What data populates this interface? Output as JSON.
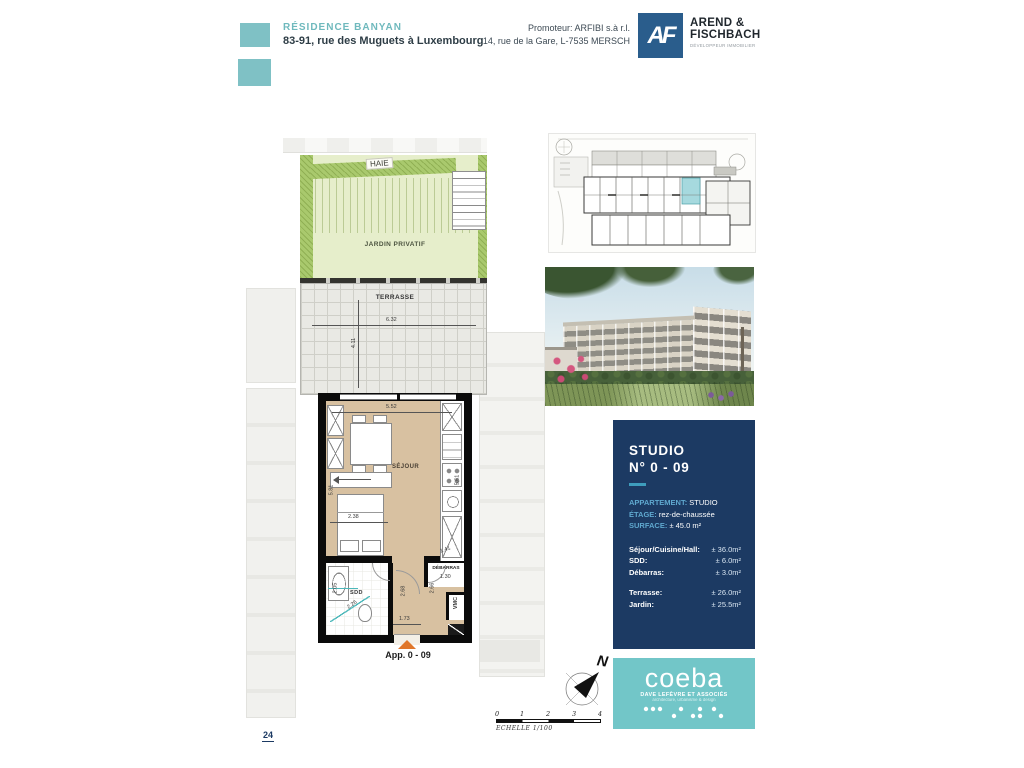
{
  "page_number": "24",
  "header": {
    "residence_name": "RÉSIDENCE BANYAN",
    "address": "83-91, rue des Muguets à Luxembourg",
    "promoter_line1": "Promoteur: ARFIBI s.à r.l.",
    "promoter_line2": "14, rue de la Gare, L-7535 MERSCH",
    "developer_monogram": "AF",
    "developer_name_line1": "AREND &",
    "developer_name_line2": "FISCHBACH",
    "developer_tagline": "DÉVELOPPEUR IMMOBILIER"
  },
  "plan": {
    "labels": {
      "haie": "HAIE",
      "jardin": "JARDIN PRIVATIF",
      "terrasse": "TERRASSE",
      "sejour": "SÉJOUR",
      "sdd": "SDD",
      "debarras": "DÉBARRAS",
      "vmc": "VMC",
      "apartment": "App. 0 - 09"
    },
    "dimensions": {
      "terrace_width": "6.32",
      "terrace_depth": "4.11",
      "sejour_width": "5.52",
      "sejour_height_left": "5.81",
      "sejour_height_right": "5.61",
      "bed_width": "2.38",
      "debarras_width": "1.41",
      "debarras_depth": "1.30",
      "hall_height": "2.68",
      "hall_height2": "2.66",
      "entry_width": "1.73",
      "sdd_width": "2.26",
      "sdd_height": "2.05"
    }
  },
  "info_panel": {
    "title_line1": "STUDIO",
    "title_line2": "N° 0 - 09",
    "apartment_label": "APPARTEMENT:",
    "apartment_value": "STUDIO",
    "etage_label": "ÉTAGE:",
    "etage_value": "rez-de-chaussée",
    "surface_label": "SURFACE:",
    "surface_value": "± 45.0 m²",
    "rooms": [
      {
        "label": "Séjour/Cuisine/Hall:",
        "value": "± 36.0m²"
      },
      {
        "label": "SDD:",
        "value": "± 6.0m²"
      },
      {
        "label": "Débarras:",
        "value": "± 3.0m²"
      }
    ],
    "outdoor": [
      {
        "label": "Terrasse:",
        "value": "± 26.0m²"
      },
      {
        "label": "Jardin:",
        "value": "± 25.5m²"
      }
    ]
  },
  "compass": {
    "north_label": "N"
  },
  "scale_bar": {
    "ticks": [
      "0",
      "1",
      "2",
      "3",
      "4"
    ],
    "label": "ECHELLE  1/100"
  },
  "architect": {
    "name": "coeba",
    "subtitle": "DAVE LEFÈVRE ET ASSOCIÉS",
    "tagline": "architecture, urbanisme & design"
  },
  "colors": {
    "teal_accent": "#7fc1c5",
    "navy_panel": "#1c3a63",
    "panel_label_blue": "#5fa8cf",
    "coeba_teal": "#72c6c8",
    "entry_arrow_orange": "#e0762a",
    "garden_green": "#e6eecb",
    "hedge_green": "#a9c96d",
    "floor_tan": "#d8c1a1",
    "highlight_unit_teal": "#a6d9de"
  }
}
